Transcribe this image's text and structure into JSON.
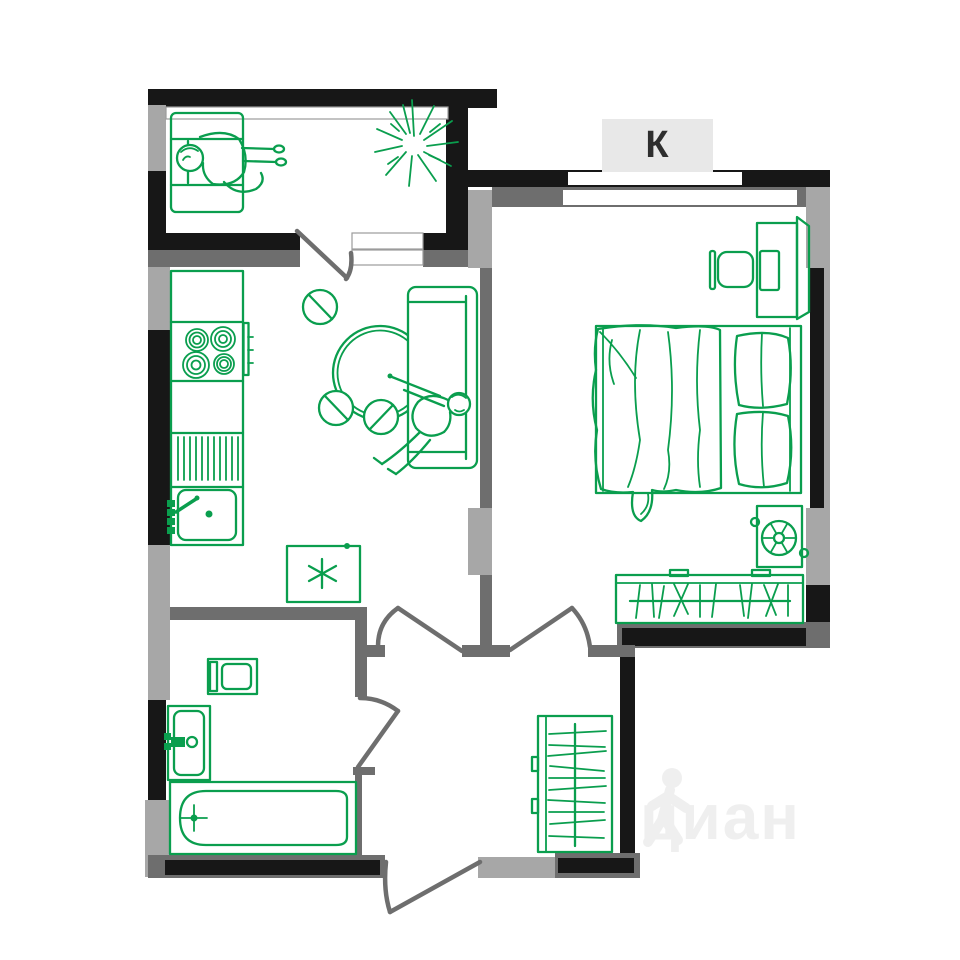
{
  "plan": {
    "room_label": "К",
    "watermark": "циан",
    "colors": {
      "furniture_green": "#0a9e4e",
      "wall_black": "#171717",
      "wall_dark_gray": "#6e6e6e",
      "wall_light_gray": "#a7a7a7",
      "label_bg": "#e8e8e8",
      "label_text": "#2e2e2e",
      "watermark_gray": "#efefef",
      "background": "#ffffff"
    },
    "furniture_icons": [
      "armchair-with-person-icon",
      "plant-starburst-icon",
      "kitchen-counter-icon",
      "stove-burners-icon",
      "dish-drainer-icon",
      "kitchen-sink-icon",
      "fridge-asterisk-icon",
      "dining-table-icon",
      "chair-icon",
      "sofa-with-person-icon",
      "desk-icon",
      "office-chair-icon",
      "monitor-icon",
      "double-bed-icon",
      "pillows-icon",
      "blanket-icon",
      "fan-unit-icon",
      "wardrobe-hangers-icon",
      "hall-wardrobe-hangers-icon",
      "washing-machine-icon",
      "bathroom-sink-icon",
      "bathtub-icon"
    ]
  }
}
